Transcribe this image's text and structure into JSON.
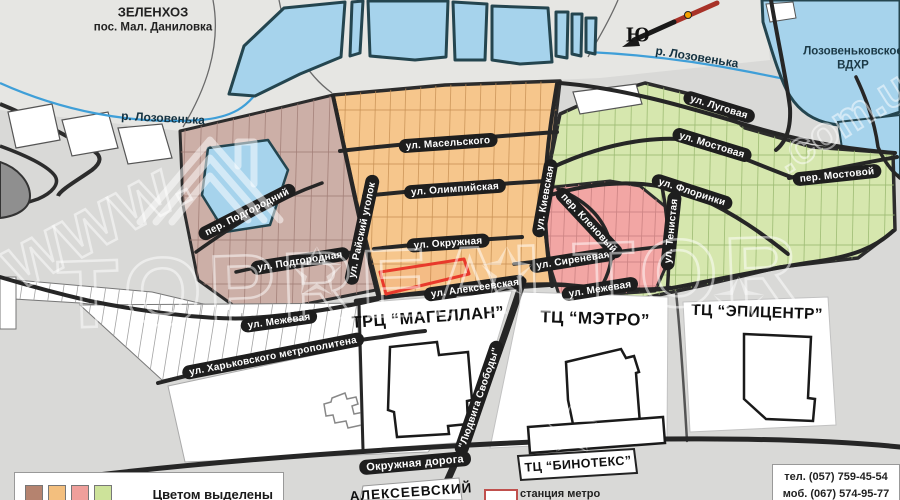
{
  "areas": {
    "zelenkhoz_line1": "ЗЕЛЕНХОЗ",
    "zelenkhoz_line2": "пос. Мал. Даниловка",
    "reservoir_line1": "Лозовеньковское",
    "reservoir_line2": "ВДХР",
    "district": "АЛЕКСЕЕВСКИЙ"
  },
  "river": {
    "label_left": "р. Лозовенька",
    "label_right": "р. Лозовенька"
  },
  "compass": {
    "south": "Ю"
  },
  "streets": {
    "maselskogo": "ул. Масельского",
    "olimpiyskaya": "ул. Олимпийская",
    "okruzhnaya": "ул. Окружная",
    "alekseevskaya": "ул. Алексеевская",
    "rayskiy_ugolok": "ул. Райский уголок",
    "kievskaya": "ул. Киевская",
    "per_podgorodniy": "пер. Подгородний",
    "podgorodnaya": "ул. Подгородная",
    "mezhevaya_left": "ул. Межевая",
    "kharkovskogo_metropolitena": "ул. Харьковского метрополитена",
    "sirenevaya": "ул. Сиреневая",
    "mezhevaya_right": "ул. Межевая",
    "per_klenoviy": "пер. Кленовый",
    "lugovaya": "ул. Луговая",
    "mostovaya": "ул. Мостовая",
    "florinki": "ул. Флоринки",
    "per_mostovoy": "пер. Мостовой",
    "tenistaya": "ул. Тенистая",
    "okruzhnaya_doroga": "Окружная дорога",
    "lyudviga_svobody": "\"Людвига Свободы\""
  },
  "malls": {
    "magellan": "ТРЦ “МАГЕЛЛАН”",
    "metro": "ТЦ “МЭТРО”",
    "epicentr": "ТЦ “ЭПИЦЕНТР”",
    "binoteks": "ТЦ “БИНОТЕКС”"
  },
  "legend": {
    "text": "Цветом выделены",
    "metro_station": "станция метро",
    "colors": [
      "#b5836f",
      "#f3bf7e",
      "#ef9f9b",
      "#cde39a"
    ]
  },
  "contacts": {
    "tel": "тел. (057) 759-45-54",
    "mob": "моб. (067) 574-95-77"
  },
  "watermark": {
    "prefix": "www.",
    "brand": "TOPREALTOR",
    "suffix": ".com.ua"
  },
  "map_colors": {
    "zone_mauve": "#ccafa7",
    "zone_orange": "#f6c68c",
    "zone_pink": "#f2a6a4",
    "zone_green": "#d6e7ae",
    "water": "#a6d3ec",
    "road": "#262626",
    "highlight_red": "#e8392b"
  }
}
